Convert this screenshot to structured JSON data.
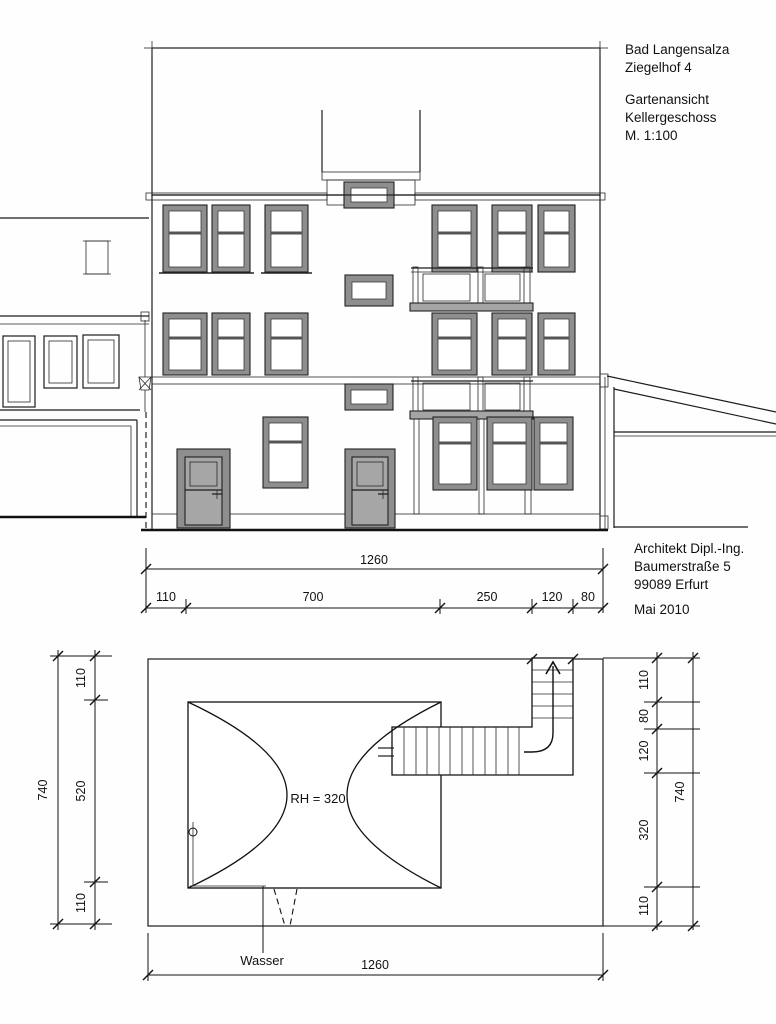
{
  "title_block": {
    "location": "Bad Langensalza",
    "address": "Ziegelhof 4",
    "view": "Gartenansicht",
    "level": "Kellergeschoss",
    "scale": "M. 1:100"
  },
  "architect_block": {
    "role": "Architekt Dipl.-Ing.",
    "street": "Baumerstraße 5",
    "city": "99089 Erfurt",
    "date": "Mai 2010"
  },
  "elevation_dimensions": {
    "total": "1260",
    "segments": [
      "110",
      "700",
      "250",
      "120",
      "80"
    ]
  },
  "plan_dimensions": {
    "left": {
      "total": "740",
      "segments": [
        "110",
        "520",
        "110"
      ]
    },
    "right": {
      "total": "740",
      "segments": [
        "110",
        "80",
        "120",
        "320",
        "110"
      ]
    },
    "bottom_total": "1260"
  },
  "plan_labels": {
    "room_height": "RH = 320",
    "water": "Wasser"
  },
  "colors": {
    "roof": "#F7B494",
    "facade": "#F9F5BC",
    "window_frame": "#8E8E8E",
    "door_frame": "#8E8E8E",
    "door_leaf": "#A6A6A6",
    "balcony_panel": "#A8A8A8",
    "cornice": "#A5A5A5",
    "base": "#AFAFAF",
    "post": "#8A8A8A",
    "plan_wall": "#7D7D7D"
  }
}
